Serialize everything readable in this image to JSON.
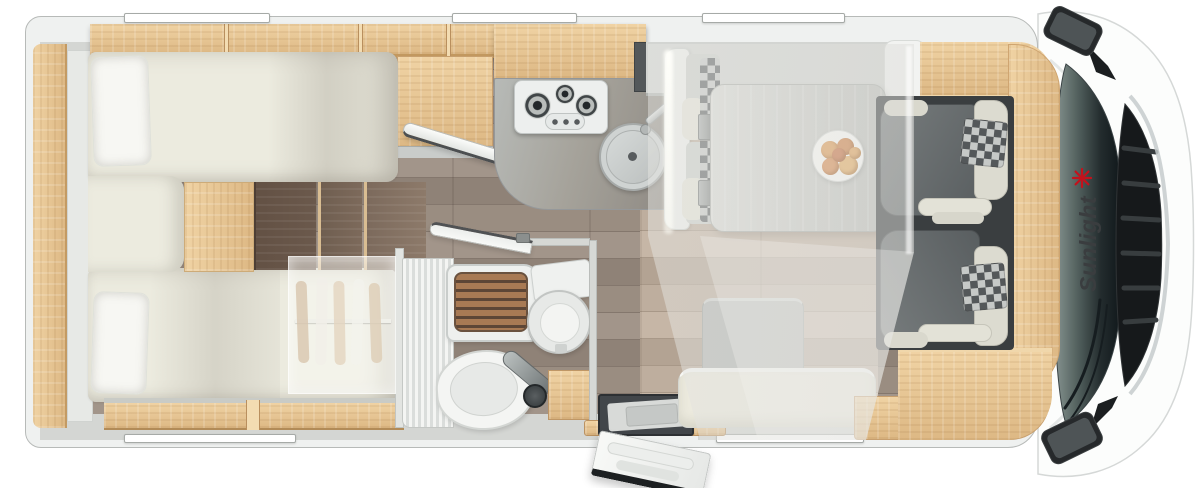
{
  "meta": {
    "title": "Motorhome floor plan - top view",
    "type": "floorplan-illustration"
  },
  "brand": {
    "label": "Sunlight",
    "logo_icon": "sun-palm-icon",
    "accent_color": "#c3121c",
    "text_color": "#3a3d3f"
  },
  "colors": {
    "page_bg": "#ffffff",
    "body_shell": "#eff1f0",
    "body_border": "#b7bab8",
    "wall": "#d4d6d3",
    "wood_light": "#f0d3a4",
    "wood_mid": "#ddb884",
    "wood_edge": "#c2985f",
    "step_dark": "#6b594c",
    "step_mid": "#7d6a5b",
    "step_light": "#8d7a6a",
    "floor_a": "#9a8d81",
    "floor_b": "#84776d",
    "floor_c": "#a2958a",
    "floor_d": "#8f8277",
    "floorl_a": "#beae9e",
    "floorl_b": "#a89888",
    "floorl_c": "#c6b6a6",
    "floorl_d": "#b3a393",
    "mattress": "#ecebdf",
    "pillow": "#f7f7f3",
    "counter_light": "#b7bab7",
    "counter_dark": "#8b8680",
    "stove": "#edefee",
    "sink": "#cfd3d2",
    "slat": "#a87a54",
    "slat_gap": "#5d4636",
    "fixture": "#f2f3f1",
    "cab_floor": "#3a3e40",
    "seat_gray": "#696e70",
    "seat_cream": "#deddd2",
    "checker_dark": "#54585a",
    "checker_light": "#c6c9c7",
    "grille": "#16191b",
    "mist": "rgba(235,235,231,0.5)"
  },
  "windows": {
    "top_count": 3,
    "bottom_count": 2
  },
  "rooms": [
    {
      "id": "rear-bedroom",
      "name": "twin-single-beds",
      "fixtures": [
        "overhead-lockers",
        "single-bed-top",
        "single-bed-bottom",
        "pillows",
        "bed-steps",
        "wardrobe-with-hangers",
        "under-bed-locker"
      ]
    },
    {
      "id": "kitchen",
      "name": "kitchen",
      "fixtures": [
        "overhead-locker",
        "tall-cabinet",
        "worktop",
        "gas-hob-3-burner",
        "round-sink-with-lid",
        "faucet"
      ]
    },
    {
      "id": "bathroom",
      "name": "bathroom",
      "fixtures": [
        "shower-teak-grate",
        "toilet",
        "washbasin",
        "mixer-tap",
        "vanity-cabinet",
        "open-door"
      ]
    },
    {
      "id": "entrance",
      "name": "entrance",
      "fixtures": [
        "entry-step-well",
        "open-entry-door",
        "threshold"
      ]
    },
    {
      "id": "dinette",
      "name": "half-dinette",
      "fixtures": [
        "sideboard",
        "bench-seat",
        "table",
        "fruit-plate",
        "side-bench",
        "drop-down-bed-overlay"
      ]
    },
    {
      "id": "cab",
      "name": "driver-cab",
      "fixtures": [
        "swivel-seat",
        "swivel-seat",
        "dashboard-wood-trim",
        "windshield",
        "wipers",
        "grille",
        "side-mirror",
        "side-mirror",
        "brand-logo"
      ]
    }
  ]
}
